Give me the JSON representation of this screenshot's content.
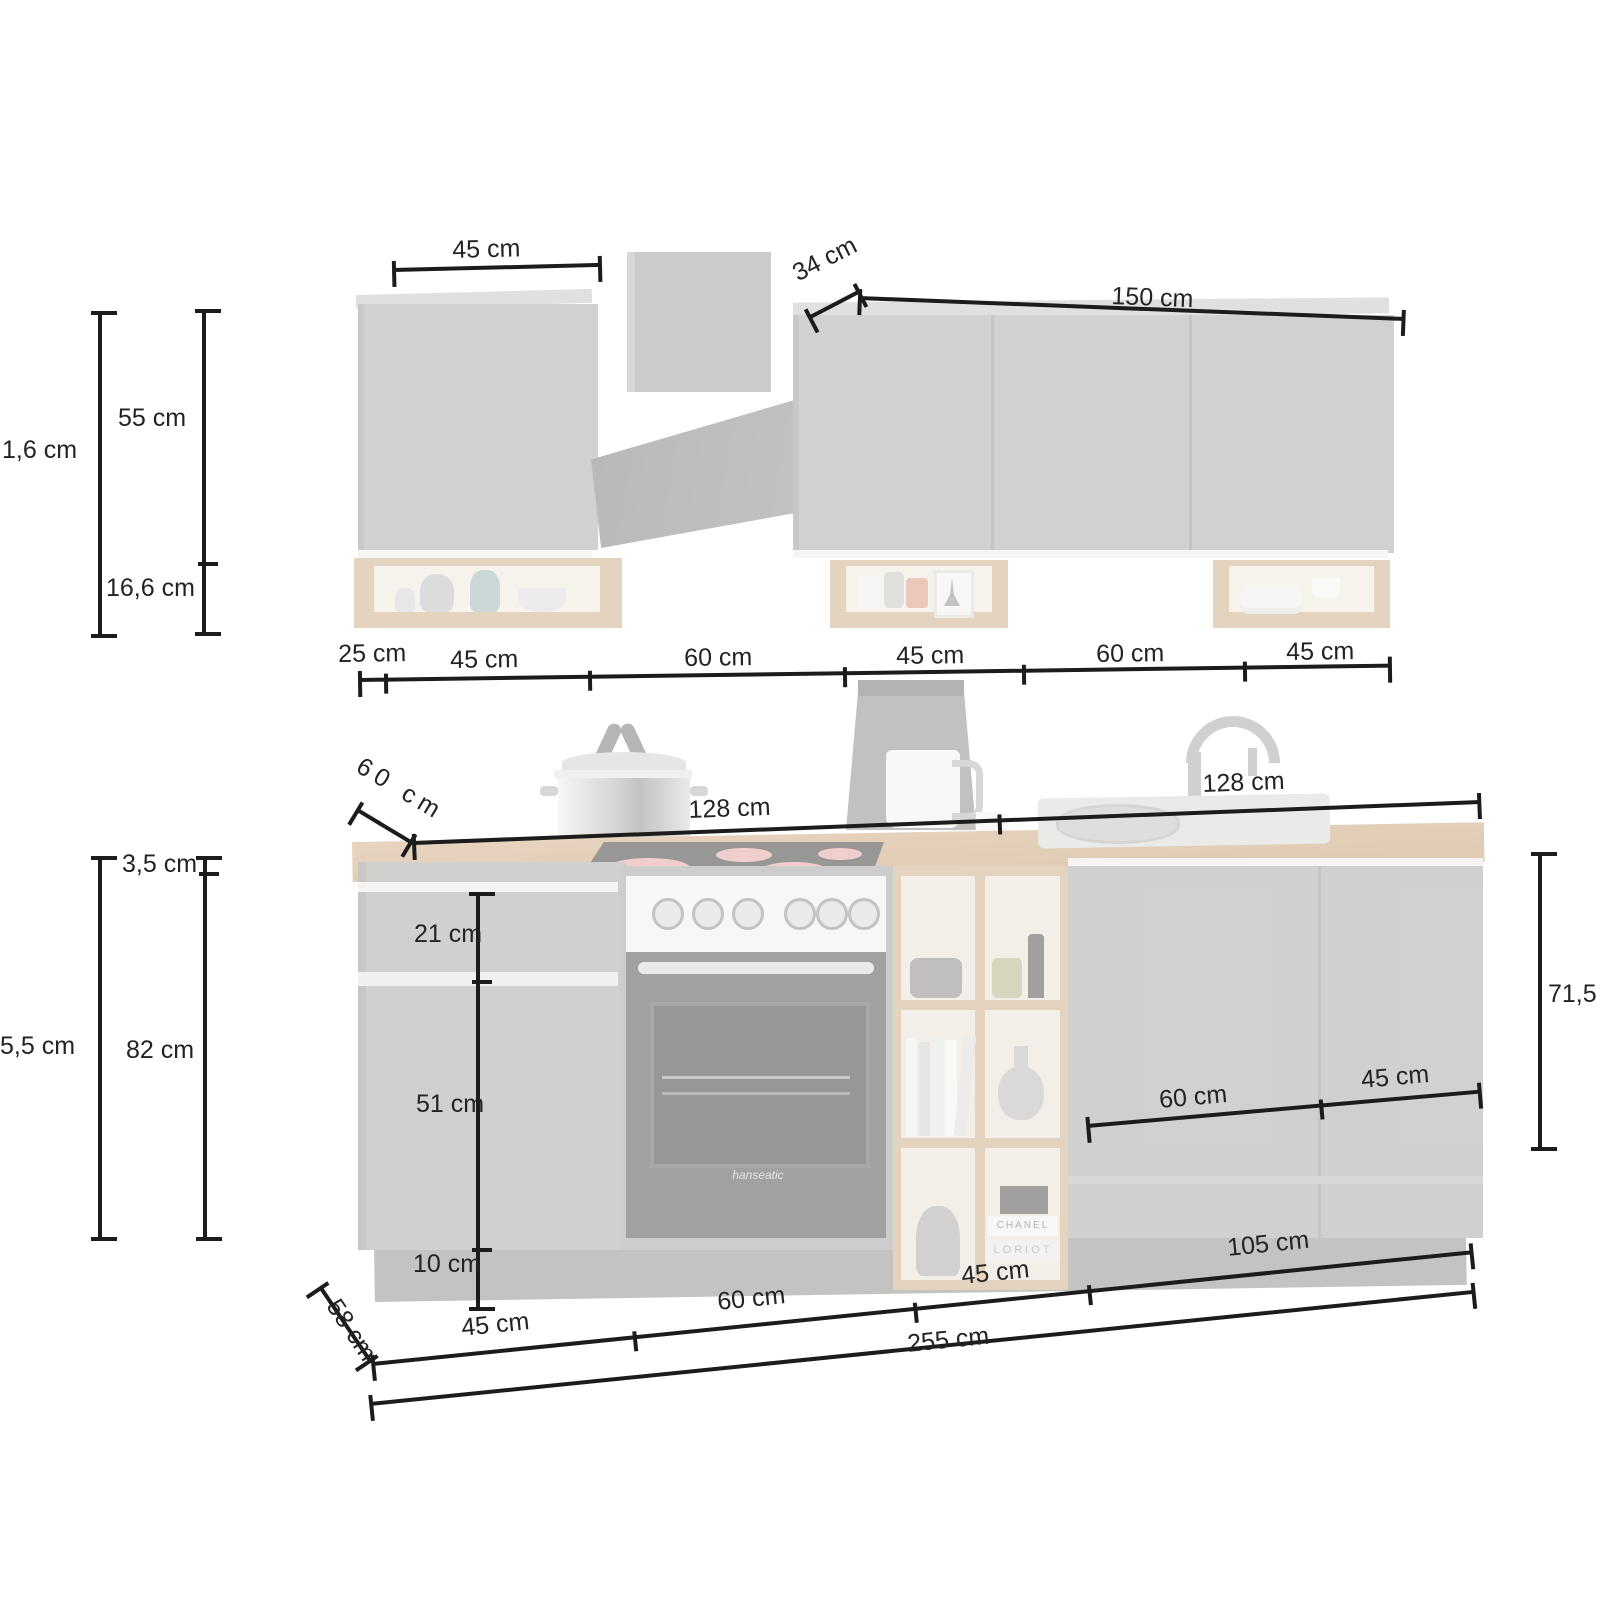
{
  "dims": {
    "wall": {
      "left_width": "45 cm",
      "hood_depth": "34 cm",
      "right_width": "150 cm",
      "total_height": "1,6 cm",
      "cabinet_height": "55 cm",
      "shelf_height": "16,6 cm",
      "shelf_depth": "25 cm",
      "bottom_segments": [
        "45 cm",
        "60 cm",
        "45 cm",
        "60 cm",
        "45 cm"
      ]
    },
    "counter": {
      "depth": "60 cm",
      "left_span": "128 cm",
      "right_span": "128 cm"
    },
    "base": {
      "worktop_thickness": "3,5 cm",
      "total_height": "5,5 cm",
      "carcass_height": "82 cm",
      "drawer_height": "21 cm",
      "door_height": "51 cm",
      "plinth_height": "10 cm",
      "right_height": "71,5",
      "door_60": "60 cm",
      "door_45": "45 cm",
      "depth": "58 cm",
      "front_segments": [
        "45 cm",
        "60 cm",
        "45 cm",
        "105 cm"
      ],
      "total_width": "255 cm"
    }
  },
  "decor": {
    "oven_brand": "hanseatic",
    "book_top": "CHANEL",
    "book_bottom": "LORIOT"
  },
  "colors": {
    "dimension_line": "#1c1c1c",
    "cabinet_grey": "#a9a8a6",
    "wood_oak": "#cdab83",
    "hood_dark": "#6f6e6c"
  }
}
